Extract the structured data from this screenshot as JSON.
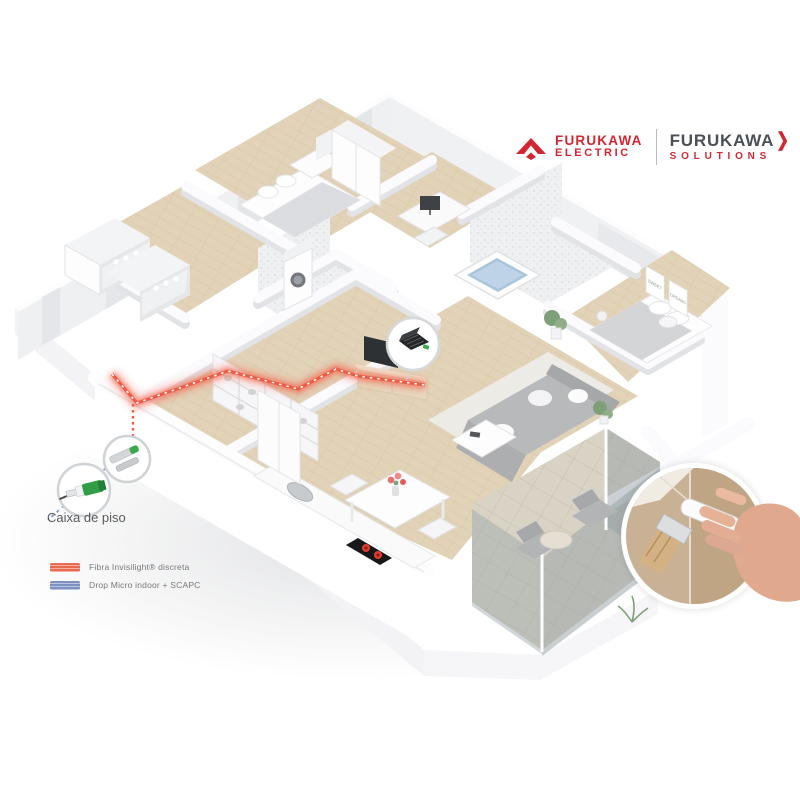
{
  "brand": {
    "electric": {
      "line1": "FURUKAWA",
      "line2": "ELECTRIC"
    },
    "solutions": {
      "line1": "FURUKAWA",
      "chevron": "❯",
      "line2": "SOLUTIONS"
    }
  },
  "floor_box": {
    "label": "Caixa de piso"
  },
  "legend": {
    "items": [
      {
        "label": "Fibra Invisilight® discreta",
        "color": "#ee5a44"
      },
      {
        "label": "Drop Micro indoor + SCAPC",
        "color": "#8494c8"
      }
    ]
  },
  "posters": {
    "sweet": "SWEET",
    "dreams": "DREAMS"
  },
  "colors": {
    "fiber_red": "#ee5a44",
    "drop_blue": "#8494c8",
    "brand_red": "#d22630",
    "brand_gray": "#4a5055",
    "wood_floor": "#e2d3b8",
    "wall_white": "#fbfbfd"
  }
}
